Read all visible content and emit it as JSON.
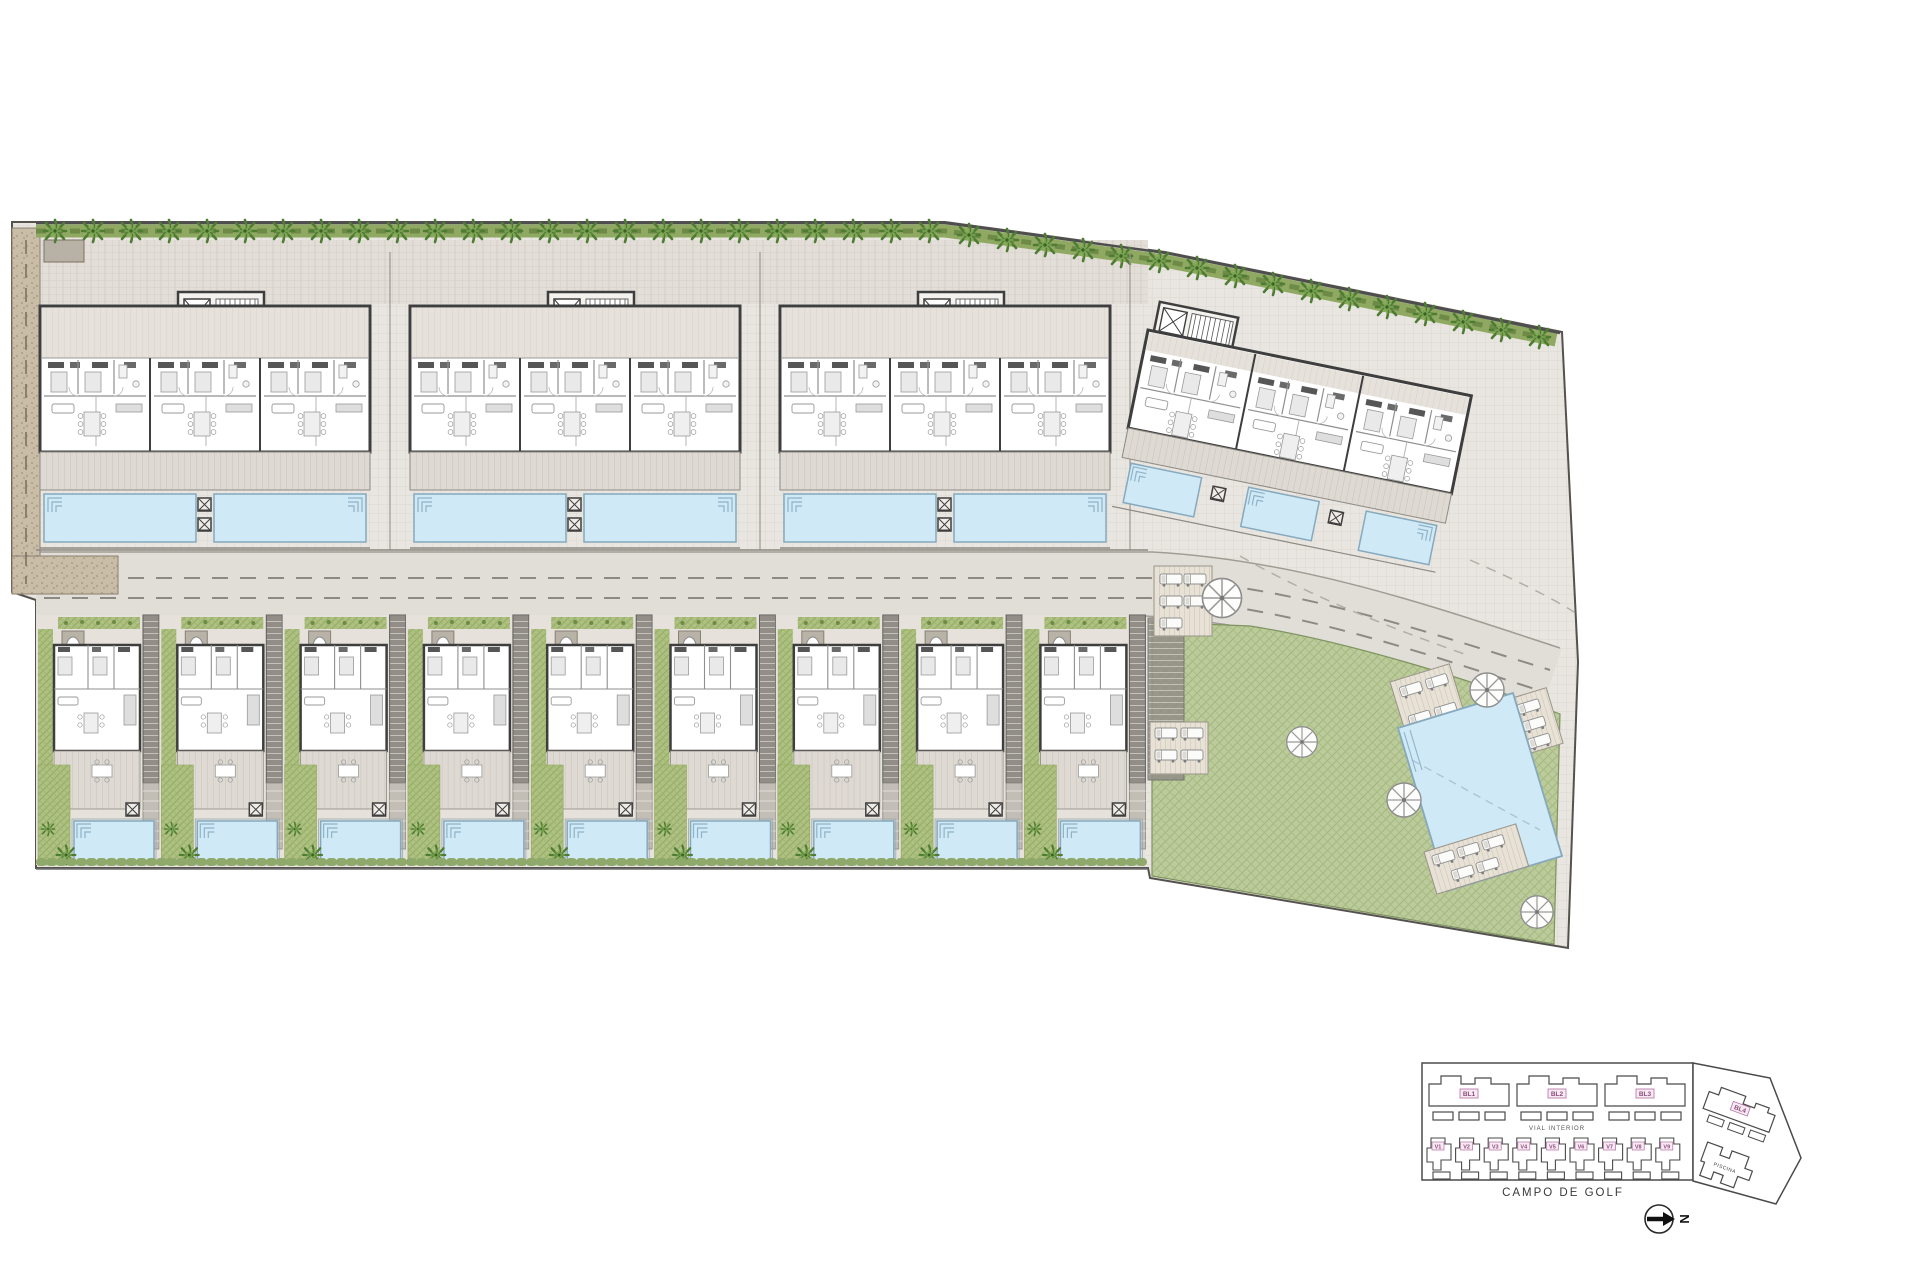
{
  "site": {
    "description": "Residential development master plan",
    "apartment_blocks": 3,
    "rotated_blocks": 1,
    "villas": 9,
    "private_pools": 18,
    "communal_pools": 1
  },
  "keyplan": {
    "blocks": [
      "BL1",
      "BL2",
      "BL3"
    ],
    "block4_label": "BL4",
    "villas": [
      "V1",
      "V2",
      "V3",
      "V4",
      "V5",
      "V6",
      "V7",
      "V8",
      "V9"
    ],
    "road_label": "VIAL INTERIOR",
    "golf_label": "CAMPO DE GOLF",
    "pool_label": "PISCINA",
    "north_label": "N"
  },
  "icons": {
    "palm-tree": "radial frond glyph",
    "umbrella": "8-spoke parasol circle",
    "north-arrow": "filled right arrow in circle"
  },
  "palette": {
    "paving": "#e9e6e1",
    "walkway": "#e3dfd8",
    "road": "#e1ddd7",
    "gravel": "#c9bda7",
    "hedge": "#8fa962",
    "palm": "#4e7c33",
    "lawn": "#b9c996",
    "garden": "#aabf80",
    "pool_water": "#cfe9f7",
    "pool_edge": "#86a9bd",
    "wall": "#3e3e3e",
    "keyplan_line": "#4a4a4a",
    "label_pink": "#b66fa3"
  }
}
